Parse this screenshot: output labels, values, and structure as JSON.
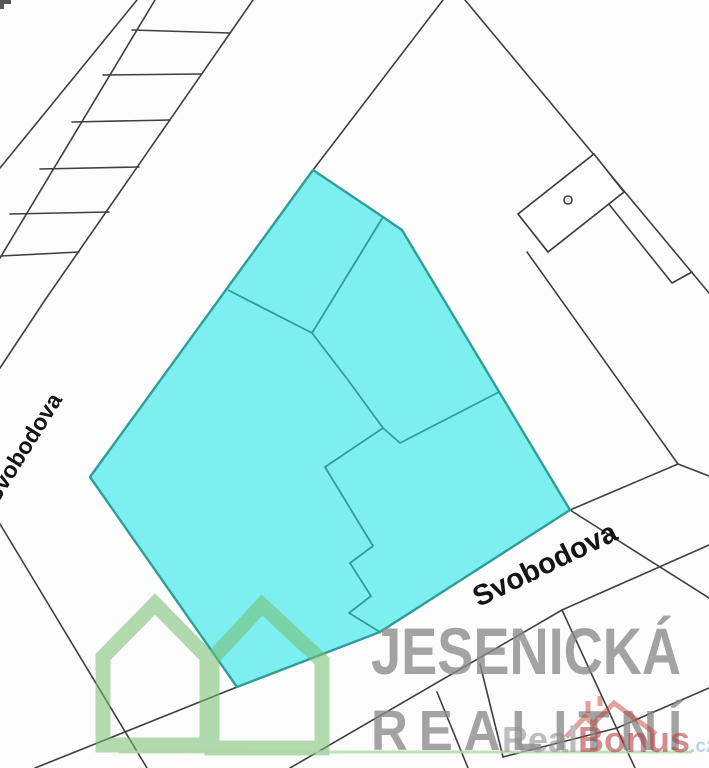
{
  "map": {
    "street_label_left": "Svobodova",
    "street_label_right": "Svobodova",
    "highlighted_parcel_fill": "#7deff0",
    "highlighted_parcel_stroke": "#2f9e99",
    "boundary_line_color": "#3f3f3f"
  },
  "watermark": {
    "agency_name_line1": "JESENICKÁ",
    "agency_name_line2": "REALITNÍ",
    "agency_text_color": "#8a8a8a",
    "logo_green": "#74bd6e",
    "underline_green": "#aed7a6",
    "portal_part1": "Real",
    "portal_part2": "Bonus",
    "portal_suffix": ".cz",
    "portal_part1_color": "#909090",
    "portal_part2_color": "#b04040",
    "portal_suffix_color": "#85bdd6",
    "portal_roof_color": "#c0392b"
  }
}
